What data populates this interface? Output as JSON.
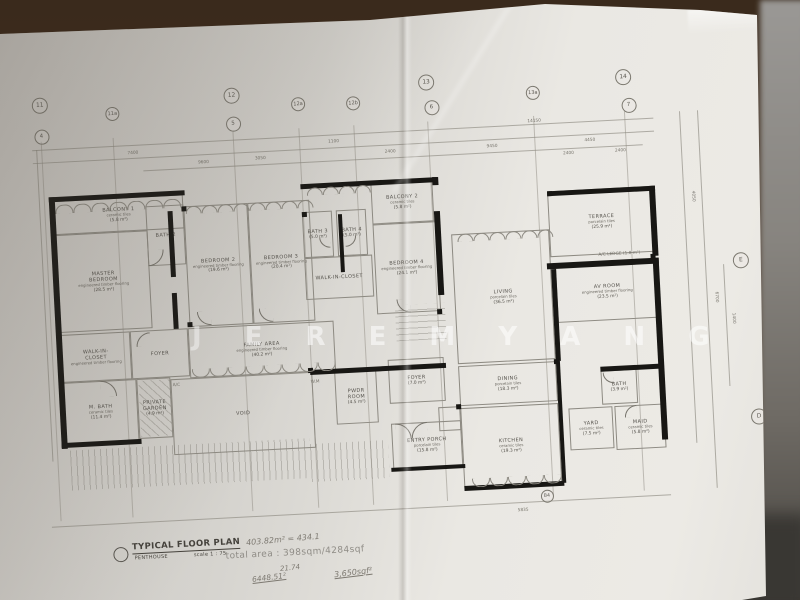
{
  "watermark": {
    "text": "J E R E M Y  A N G"
  },
  "title_block": {
    "title": "TYPICAL FLOOR PLAN",
    "subtitle": "PENTHOUSE",
    "scale": "scale 1 : 75",
    "total_area": "total area : 398sqm/4284sqf"
  },
  "handwriting": [
    {
      "text": "403.82m² = 434.1",
      "x": 246,
      "y": 535,
      "r": -5,
      "fs": 8,
      "u": false
    },
    {
      "text": "21.74",
      "x": 280,
      "y": 564,
      "r": -6,
      "fs": 7,
      "u": false
    },
    {
      "text": "6448.51²",
      "x": 252,
      "y": 573,
      "r": -7,
      "fs": 7.5,
      "u": true
    },
    {
      "text": "3,650sqf²",
      "x": 334,
      "y": 568,
      "r": -7,
      "fs": 8,
      "u": true
    }
  ],
  "plan": {
    "rotation_deg": -3,
    "grid_bubbles": [
      {
        "t": "11",
        "x": 49,
        "y": 105,
        "s": 14
      },
      {
        "t": "11a",
        "x": 121,
        "y": 117,
        "s": 12
      },
      {
        "t": "12",
        "x": 241,
        "y": 105,
        "s": 14
      },
      {
        "t": "12a",
        "x": 307,
        "y": 117,
        "s": 12
      },
      {
        "t": "12b",
        "x": 362,
        "y": 119,
        "s": 12
      },
      {
        "t": "13",
        "x": 436,
        "y": 102,
        "s": 14
      },
      {
        "t": "13a",
        "x": 542,
        "y": 118,
        "s": 12
      },
      {
        "t": "14",
        "x": 633,
        "y": 107,
        "s": 14
      },
      {
        "t": "4",
        "x": 49,
        "y": 136,
        "s": 13
      },
      {
        "t": "5",
        "x": 241,
        "y": 133,
        "s": 13
      },
      {
        "t": "6",
        "x": 440,
        "y": 127,
        "s": 13
      },
      {
        "t": "7",
        "x": 637,
        "y": 135,
        "s": 13
      },
      {
        "t": "E",
        "x": 741,
        "y": 296,
        "s": 14
      },
      {
        "t": "D",
        "x": 751,
        "y": 453,
        "s": 14
      },
      {
        "t": "B4",
        "x": 535,
        "y": 521,
        "s": 11
      }
    ],
    "rooms": [
      {
        "n": "BALCONY 1",
        "s": "ceramic tiles",
        "a": "(5.8 m²)",
        "x": 58,
        "y": 202,
        "w": 130,
        "h": 34
      },
      {
        "n": "MASTER",
        "n2": "BEDROOM",
        "s": "engineered timber flooring",
        "a": "(28.5 m²)",
        "x": 58,
        "y": 236,
        "w": 93,
        "h": 98
      },
      {
        "n": "BATH 2",
        "s": "",
        "a": "",
        "x": 150,
        "y": 212,
        "w": 38,
        "h": 60
      },
      {
        "n": "BEDROOM 2",
        "s": "engineered timber flooring",
        "a": "(19.6 m²)",
        "x": 188,
        "y": 214,
        "w": 64,
        "h": 121
      },
      {
        "n": "BEDROOM 3",
        "s": "engineered timber flooring",
        "a": "(20.4 m²)",
        "x": 252,
        "y": 214,
        "w": 62,
        "h": 121
      },
      {
        "n": "BATH 3",
        "s": "",
        "a": "(5.0 m²)",
        "x": 306,
        "y": 226,
        "w": 30,
        "h": 46
      },
      {
        "n": "BATH 4",
        "s": "",
        "a": "(5.0 m²)",
        "x": 340,
        "y": 226,
        "w": 30,
        "h": 46
      },
      {
        "n": "WALK-IN-CLOSET",
        "s": "",
        "a": "",
        "x": 306,
        "y": 272,
        "w": 68,
        "h": 42
      },
      {
        "n": "BALCONY 2",
        "s": "ceramic tiles",
        "a": "(5.8 m²)",
        "x": 376,
        "y": 200,
        "w": 62,
        "h": 42
      },
      {
        "n": "BEDROOM 4",
        "s": "engineered timber flooring",
        "a": "(24.1 m²)",
        "x": 376,
        "y": 242,
        "w": 64,
        "h": 90
      },
      {
        "n": "WALK-IN-",
        "n2": "CLOSET",
        "s": "engineered timber flooring",
        "a": "",
        "x": 58,
        "y": 336,
        "w": 70,
        "h": 48
      },
      {
        "n": "FOYER",
        "s": "",
        "a": "",
        "x": 128,
        "y": 336,
        "w": 58,
        "h": 48
      },
      {
        "n": "FAMILY AREA",
        "s": "engineered timber flooring",
        "a": "(40.2 m²)",
        "x": 186,
        "y": 336,
        "w": 146,
        "h": 50
      },
      {
        "n": "M. BATH",
        "s": "ceramic tiles",
        "a": "(11.4 m²)",
        "x": 58,
        "y": 384,
        "w": 74,
        "h": 62
      },
      {
        "n": "PRIVATE",
        "n2": "GARDEN",
        "s": "",
        "a": "(4.9 m²)",
        "x": 132,
        "y": 384,
        "w": 34,
        "h": 60
      },
      {
        "n": "VOID",
        "s": "",
        "a": "",
        "x": 166,
        "y": 386,
        "w": 142,
        "h": 76
      },
      {
        "n": "PWDR",
        "n2": "ROOM",
        "s": "",
        "a": "(4.5 m²)",
        "x": 330,
        "y": 386,
        "w": 42,
        "h": 54
      },
      {
        "n": "FOYER",
        "s": "",
        "a": "(7.0 m²)",
        "x": 384,
        "y": 378,
        "w": 56,
        "h": 44
      },
      {
        "n": "ENTRY PORCH",
        "s": "porcelain tiles",
        "a": "(15.8 m²)",
        "x": 384,
        "y": 442,
        "w": 70,
        "h": 46
      },
      {
        "n": "",
        "s": "",
        "a": "",
        "x": 432,
        "y": 428,
        "w": 22,
        "h": 24
      },
      {
        "n": "LIVING",
        "s": "porcelain tiles",
        "a": "(36.5 m²)",
        "x": 454,
        "y": 256,
        "w": 98,
        "h": 130
      },
      {
        "n": "TERRACE",
        "s": "porcelain tiles",
        "a": "(25.9 m²)",
        "x": 552,
        "y": 218,
        "w": 106,
        "h": 66
      },
      {
        "n": "AV ROOM",
        "s": "engineered timber flooring",
        "a": "(23.5 m²)",
        "x": 556,
        "y": 292,
        "w": 102,
        "h": 58
      },
      {
        "n": "DINING",
        "s": "porcelain tiles",
        "a": "(18.3 m²)",
        "x": 454,
        "y": 388,
        "w": 98,
        "h": 40
      },
      {
        "n": "KITCHEN",
        "s": "ceramic tiles",
        "a": "(19.3 m²)",
        "x": 454,
        "y": 430,
        "w": 98,
        "h": 80
      },
      {
        "n": "BATH",
        "s": "",
        "a": "(3.9 m²)",
        "x": 596,
        "y": 400,
        "w": 36,
        "h": 34
      },
      {
        "n": "YARD",
        "s": "ceramic tiles",
        "a": "(7.5 m²)",
        "x": 562,
        "y": 436,
        "w": 44,
        "h": 42
      },
      {
        "n": "MAID",
        "s": "ceramic tiles",
        "a": "(5.8 m²)",
        "x": 608,
        "y": 436,
        "w": 50,
        "h": 44
      }
    ],
    "misc_labels": [
      {
        "t": "A/C",
        "x": 168,
        "y": 390
      },
      {
        "t": "W.M",
        "x": 306,
        "y": 394
      },
      {
        "t": "A/C LEDGE (1.8 m²)",
        "x": 600,
        "y": 282
      }
    ],
    "walls": [
      [
        54,
        198,
        6,
        252
      ],
      [
        54,
        198,
        136,
        5
      ],
      [
        306,
        198,
        134,
        5
      ],
      [
        172,
        218,
        5,
        66
      ],
      [
        172,
        300,
        5,
        36
      ],
      [
        342,
        230,
        4,
        58
      ],
      [
        438,
        232,
        6,
        84
      ],
      [
        438,
        198,
        6,
        8
      ],
      [
        552,
        218,
        108,
        5
      ],
      [
        654,
        218,
        6,
        70
      ],
      [
        548,
        290,
        112,
        6
      ],
      [
        654,
        290,
        6,
        182
      ],
      [
        552,
        296,
        5,
        92
      ],
      [
        54,
        444,
        80,
        5
      ],
      [
        382,
        486,
        74,
        4
      ],
      [
        454,
        508,
        100,
        5
      ],
      [
        596,
        396,
        62,
        5
      ],
      [
        306,
        384,
        136,
        5
      ],
      [
        552,
        388,
        4,
        122
      ]
    ],
    "columns": [
      [
        186,
        330
      ],
      [
        304,
        382
      ],
      [
        436,
        330
      ],
      [
        450,
        426
      ],
      [
        550,
        386
      ],
      [
        652,
        286
      ],
      [
        186,
        214
      ],
      [
        306,
        226
      ],
      [
        552,
        218
      ],
      [
        438,
        198
      ]
    ],
    "grid_lines_v": [
      49,
      121,
      241,
      307,
      362,
      436,
      542,
      633
    ],
    "dim_lines_h": [
      [
        40,
        150,
        622
      ],
      [
        40,
        163,
        622
      ],
      [
        150,
        176,
        500
      ],
      [
        40,
        527,
        620
      ]
    ],
    "dim_lines_v": [
      [
        44,
        150,
        312
      ],
      [
        688,
        145,
        332
      ],
      [
        706,
        145,
        378
      ],
      [
        724,
        300,
        122
      ]
    ],
    "dims": [
      {
        "t": "7400",
        "x": 135,
        "y": 156
      },
      {
        "t": "9600",
        "x": 205,
        "y": 169
      },
      {
        "t": "1100",
        "x": 336,
        "y": 155
      },
      {
        "t": "3050",
        "x": 262,
        "y": 168
      },
      {
        "t": "2400",
        "x": 392,
        "y": 168
      },
      {
        "t": "14150",
        "x": 536,
        "y": 145
      },
      {
        "t": "9450",
        "x": 494,
        "y": 168
      },
      {
        "t": "4450",
        "x": 592,
        "y": 167
      },
      {
        "t": "2400",
        "x": 570,
        "y": 179
      },
      {
        "t": "2400",
        "x": 622,
        "y": 179
      },
      {
        "t": "5835",
        "x": 506,
        "y": 533
      },
      {
        "t": "4050",
        "x": 692,
        "y": 228,
        "r": 90
      },
      {
        "t": "6700",
        "x": 710,
        "y": 330,
        "r": 90
      },
      {
        "t": "1400",
        "x": 726,
        "y": 352,
        "r": 90
      }
    ],
    "door_arcs": [
      {
        "x": 150,
        "y": 256,
        "r": 16,
        "q": "br"
      },
      {
        "x": 196,
        "y": 320,
        "r": 14,
        "q": "bl"
      },
      {
        "x": 258,
        "y": 320,
        "r": 14,
        "q": "bl"
      },
      {
        "x": 396,
        "y": 318,
        "r": 14,
        "q": "bl"
      },
      {
        "x": 96,
        "y": 384,
        "r": 16,
        "q": "tr"
      },
      {
        "x": 134,
        "y": 338,
        "r": 14,
        "q": "tl"
      },
      {
        "x": 322,
        "y": 252,
        "r": 11,
        "q": "bl"
      },
      {
        "x": 348,
        "y": 252,
        "r": 11,
        "q": "br"
      },
      {
        "x": 388,
        "y": 442,
        "r": 16,
        "q": "tr"
      },
      {
        "x": 404,
        "y": 442,
        "r": 16,
        "q": "tl"
      },
      {
        "x": 618,
        "y": 436,
        "r": 12,
        "q": "tl"
      },
      {
        "x": 598,
        "y": 402,
        "r": 11,
        "q": "bl"
      }
    ],
    "window_rows": [
      {
        "x": 60,
        "y": 206,
        "n": 7,
        "r": 9,
        "flip": false
      },
      {
        "x": 190,
        "y": 214,
        "n": 8,
        "r": 8,
        "flip": false
      },
      {
        "x": 312,
        "y": 202,
        "n": 4,
        "r": 8,
        "flip": false
      },
      {
        "x": 460,
        "y": 256,
        "n": 6,
        "r": 8,
        "flip": false
      },
      {
        "x": 188,
        "y": 377,
        "n": 8,
        "r": 9,
        "flip": true
      },
      {
        "x": 462,
        "y": 501,
        "n": 5,
        "r": 9,
        "flip": true
      }
    ],
    "hatches": [
      {
        "x": 62,
        "y": 452,
        "w": 240,
        "h": 40,
        "dir": "v"
      },
      {
        "x": 134,
        "y": 386,
        "w": 32,
        "h": 56,
        "dir": "d"
      },
      {
        "x": 394,
        "y": 324,
        "w": 50,
        "h": 36,
        "dir": "h"
      },
      {
        "x": 302,
        "y": 458,
        "w": 78,
        "h": 38,
        "dir": "v"
      }
    ]
  }
}
